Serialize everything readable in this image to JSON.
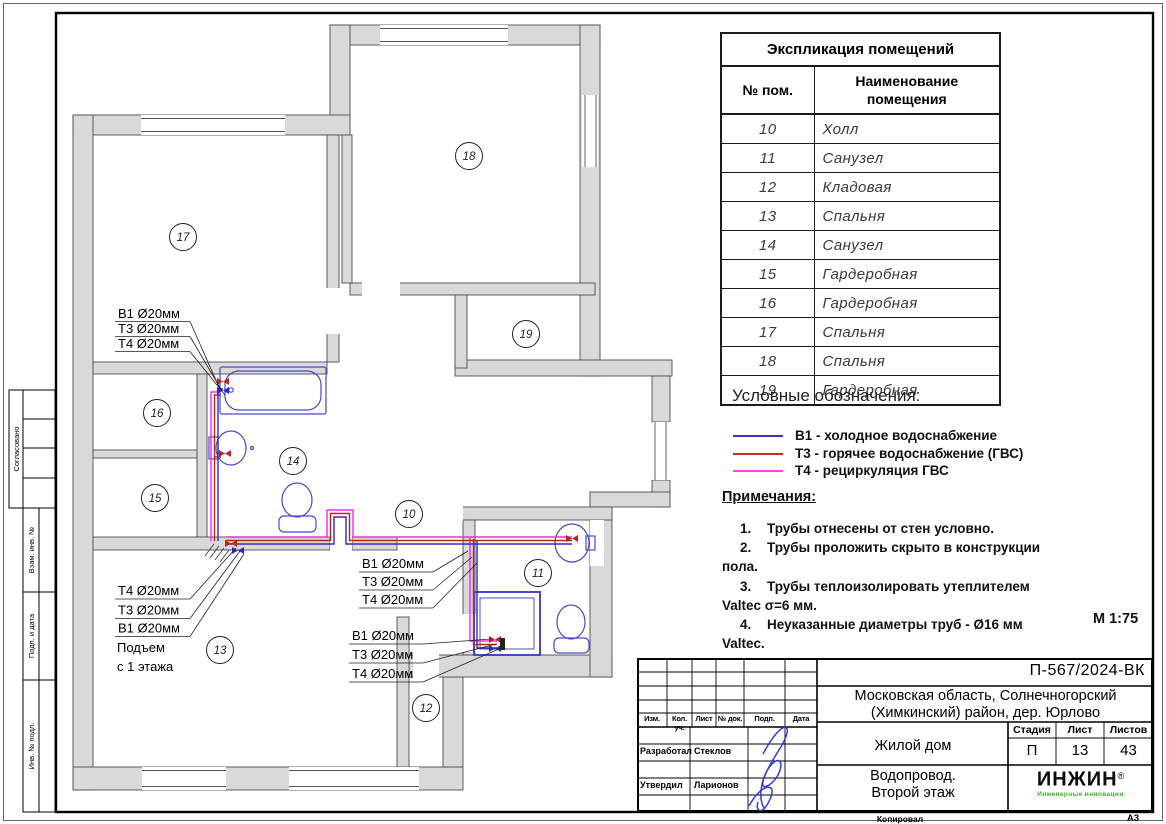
{
  "rooms_table": {
    "title": "Экспликация помещений",
    "col1": "№ пом.",
    "col2": "Наименование помещения",
    "rows": [
      [
        "10",
        "Холл"
      ],
      [
        "11",
        "Санузел"
      ],
      [
        "12",
        "Кладовая"
      ],
      [
        "13",
        "Спальня"
      ],
      [
        "14",
        "Санузел"
      ],
      [
        "15",
        "Гардеробная"
      ],
      [
        "16",
        "Гардеробная"
      ],
      [
        "17",
        "Спальня"
      ],
      [
        "18",
        "Спальня"
      ],
      [
        "19",
        "Гардеробная"
      ]
    ]
  },
  "legend": {
    "title": "Условные обозначения:",
    "items": [
      {
        "label": "В1 - холодное водоснабжение",
        "color": "#3a3aa8"
      },
      {
        "label": "Т3 - горячее водоснабжение (ГВС)",
        "color": "#c03028"
      },
      {
        "label": "Т4 - рециркуляция ГВС",
        "color": "#ee4cee"
      }
    ]
  },
  "notes": {
    "title": "Примечания:",
    "items": [
      {
        "num": "1.",
        "lines": [
          "Трубы отнесены от стен условно."
        ]
      },
      {
        "num": "2.",
        "lines": [
          "Трубы проложить скрыто в конструкции",
          "пола."
        ]
      },
      {
        "num": "3.",
        "lines": [
          "Трубы теплоизолировать утеплителем",
          "Valtec σ=6 мм."
        ]
      },
      {
        "num": "4.",
        "lines": [
          "Неуказанные диаметры труб - Ø16 мм",
          "Valtec."
        ]
      }
    ],
    "scale": "М 1:75"
  },
  "plan": {
    "colors": {
      "cold_water_B1": "#2c2cc4",
      "hot_water_T3": "#c42222",
      "recirculation_T4": "#ee2cee",
      "wall_fill": "#d9d9d9",
      "fixture": "#4848cc"
    },
    "labels": {
      "g1": [
        "В1 Ø20мм",
        "Т3 Ø20мм",
        "Т4 Ø20мм"
      ],
      "g2": [
        "Т4 Ø20мм",
        "Т3 Ø20мм",
        "В1 Ø20мм"
      ],
      "g2_note": [
        "Подъем",
        "с 1 этажа"
      ],
      "g3": [
        "В1 Ø20мм",
        "Т3 Ø20мм",
        "Т4 Ø20мм"
      ],
      "g4": [
        "В1 Ø20мм",
        "Т3 Ø20мм",
        "Т4 Ø20мм"
      ]
    },
    "room_numbers": {
      "r10": "10",
      "r11": "11",
      "r12": "12",
      "r13": "13",
      "r14": "14",
      "r15": "15",
      "r16": "16",
      "r17": "17",
      "r18": "18",
      "r19": "19"
    }
  },
  "stamp": {
    "doc_number": "П-567/2024-ВК",
    "address_line1": "Московская область, Солнечногорский",
    "address_line2": "(Химкинский) район, дер. Юрлово",
    "object_name": "Жилой дом",
    "sheet_title_line1": "Водопровод.",
    "sheet_title_line2": "Второй этаж",
    "stage_label": "Стадия",
    "sheet_label": "Лист",
    "sheets_label": "Листов",
    "stage": "П",
    "sheet": "13",
    "sheets": "43",
    "cols": [
      "Изм.",
      "Кол. уч.",
      "Лист",
      "№ док.",
      "Подп.",
      "Дата"
    ],
    "developed_label": "Разработал",
    "developed_by": "Стеклов",
    "approved_label": "Утвердил",
    "approved_by": "Ларионов",
    "copied_label": "Копировал",
    "format": "А3",
    "logo_text": "ИНЖИН",
    "logo_reg": "®",
    "logo_sub": "Инженерные инновации"
  },
  "side_stamp": {
    "agreed": "Согласовано",
    "replace_inv": "Взам. инв. №",
    "sign_date": "Подп. и дата",
    "inv_orig": "Инв. № подл."
  }
}
